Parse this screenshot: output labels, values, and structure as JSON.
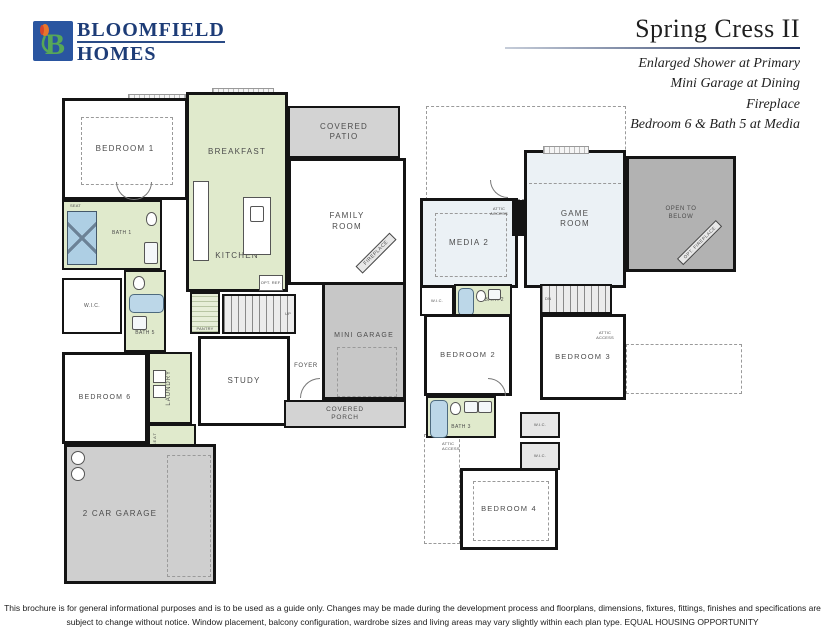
{
  "brand": {
    "line1": "BLOOMFIELD",
    "line2": "HOMES",
    "logo_letter": "B"
  },
  "header": {
    "title": "Spring Cress II",
    "options": [
      "Enlarged Shower at Primary",
      "Mini Garage at Dining",
      "Fireplace",
      "Bedroom 6 & Bath 5 at Media"
    ]
  },
  "floor1": {
    "bedroom1": "BEDROOM 1",
    "breakfast": "BREAKFAST",
    "kitchen": "KITCHEN",
    "covered_patio": "COVERED PATIO",
    "family_room": "FAMILY ROOM",
    "fireplace": "FIREPLACE",
    "bath1": "BATH 1",
    "seat": "SEAT",
    "wic": "W.I.C.",
    "bath5": "BATH 5",
    "bedroom6": "BEDROOM 6",
    "laundry": "LAUNDRY",
    "mud_seat": "SEAT",
    "pantry": "PANTRY",
    "up": "UP",
    "study": "STUDY",
    "foyer": "FOYER",
    "mini_garage": "MINI GARAGE",
    "covered_porch": "COVERED PORCH",
    "garage": "2 CAR GARAGE",
    "opt_ref": "OPT. REF."
  },
  "floor2": {
    "media2": "MEDIA 2",
    "game_room": "GAME ROOM",
    "open_to_below": "OPEN TO BELOW",
    "opt_fireplace": "OPT. FIREPLACE",
    "attic_access_media": "ATTIC ACCESS",
    "wic_bath2": "W.I.C.",
    "bath2": "BATH 2",
    "dn": "DN",
    "bedroom2": "BEDROOM 2",
    "bedroom3": "BEDROOM 3",
    "attic_access_bed3": "ATTIC ACCESS",
    "bath3": "BATH 3",
    "attic_access_hall": "ATTIC ACCESS",
    "wic_a": "W.I.C.",
    "wic_b": "W.I.C.",
    "bedroom4": "BEDROOM 4"
  },
  "footer": {
    "line1": "This brochure is for general informational purposes and is to be used as a guide only. Changes may be made during the development process and floorplans, dimensions, fixtures, fittings, finishes and specifications are",
    "line2": "subject to change without notice. Window placement, balcony configuration, wardrobe sizes and living areas may vary slightly within each plan type.  EQUAL HOUSING OPPORTUNITY"
  },
  "colors": {
    "accent_navy": "#1d3c77",
    "logo_green": "#57a758",
    "logo_orange": "#e8762b",
    "room_green": "#e0eacc",
    "room_blue": "#ebf1f5",
    "gray_patio": "#d3d3d3",
    "gray_garage": "#c7c7c7",
    "gray_open_below": "#b2b2b2"
  }
}
